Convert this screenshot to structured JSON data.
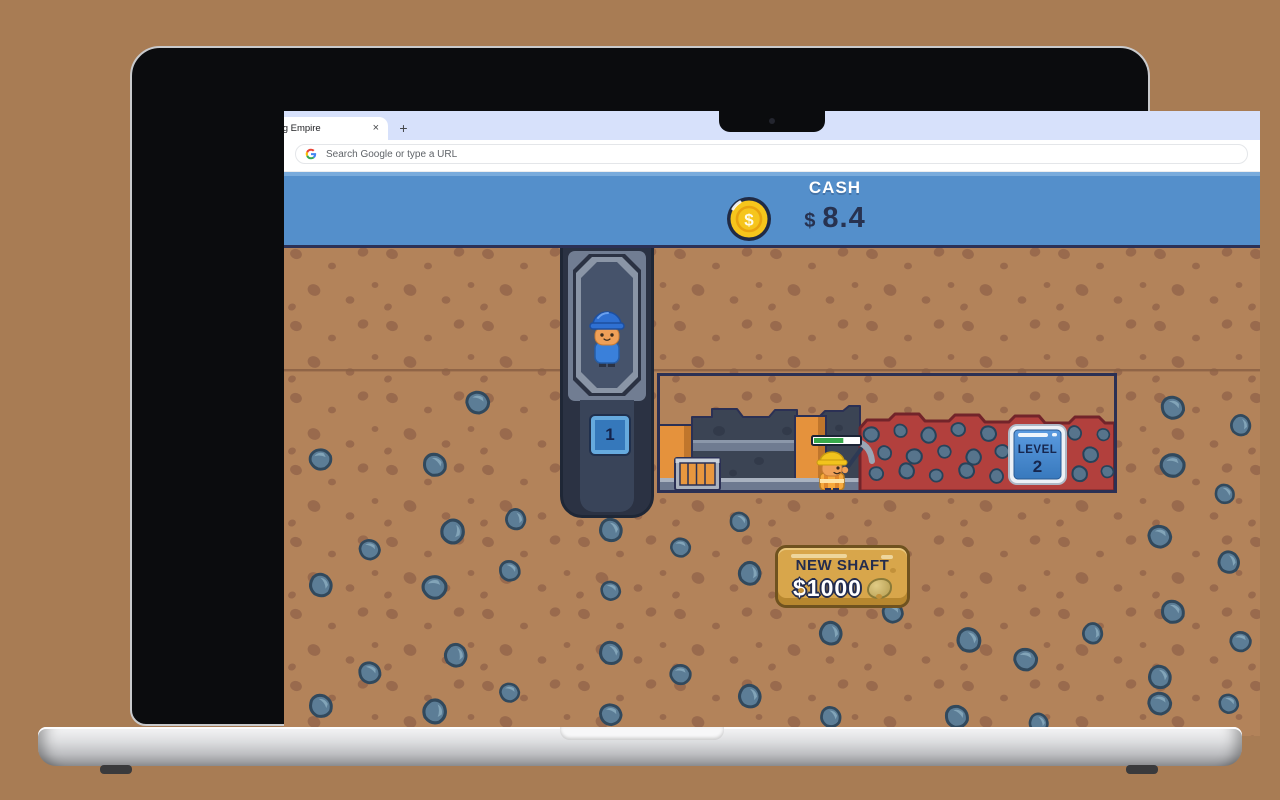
{
  "browser": {
    "tab_title": "Mining Empire",
    "tab_close": "×",
    "new_tab": "+",
    "omnibox_placeholder": "Search Google or type a URL"
  },
  "game": {
    "header": {
      "label": "CASH",
      "currency": "$",
      "value": "8.4",
      "coin_symbol": "$"
    },
    "elevator": {
      "shaft_number": "1"
    },
    "mine": {
      "level_sign": {
        "line1": "LEVEL",
        "line2": "2"
      },
      "progress_percent": 65
    },
    "shop": {
      "label": "NEW SHAFT",
      "price": "$1000"
    },
    "colors": {
      "header_blue": "#548fcb",
      "dirt_brown": "#b3835a",
      "speckle_brown": "#8f6147",
      "rock_blue": "#5c7d96",
      "ore_red": "#b2403d",
      "coin_gold": "#f6c51c",
      "navy_outline": "#232c4e",
      "button_gold": "#d8a64b",
      "progress_green": "#38a94b"
    }
  }
}
